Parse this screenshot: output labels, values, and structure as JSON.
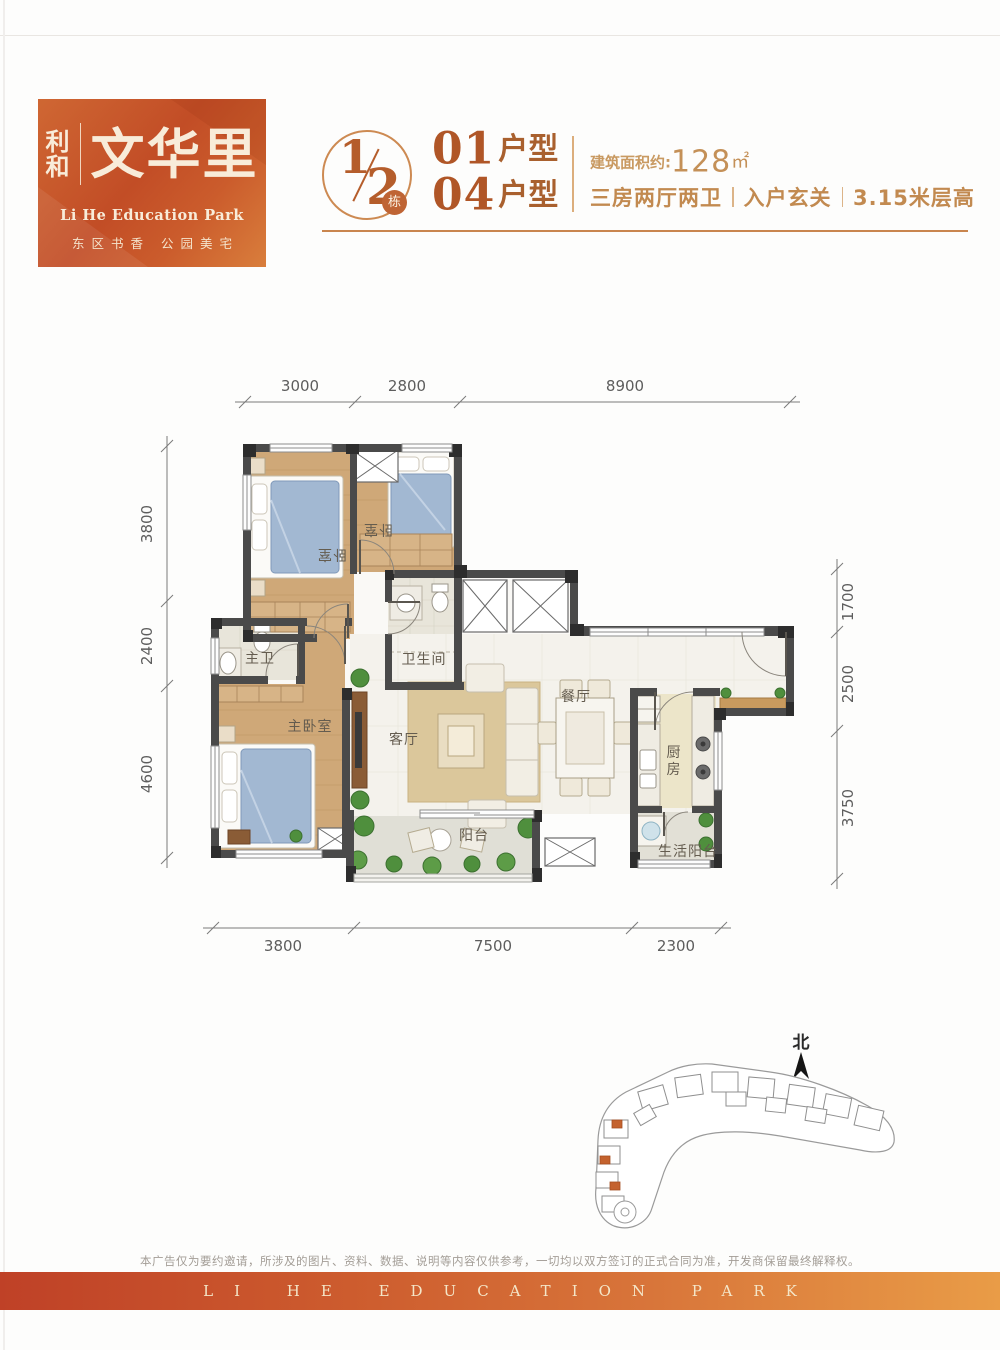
{
  "colors": {
    "brand_orange": "#c2582a",
    "accent_text": "#b05627",
    "banner_gradient_left": "#bf4127",
    "banner_gradient_right": "#e99c47",
    "wall": "#4a4a4a",
    "highlight_unit": "#c4622e"
  },
  "logo": {
    "brand": "利和",
    "name": "文华里",
    "subtitle_en": "Li He Education Park",
    "tagline": "东区书香 公园美宅"
  },
  "header": {
    "block": {
      "numerator": "1",
      "denominator": "2",
      "badge": "栋"
    },
    "units": [
      {
        "num": "01",
        "type": "户型"
      },
      {
        "num": "04",
        "type": "户型"
      }
    ],
    "area": {
      "label": "建筑面积约:",
      "value": "128",
      "unit": "㎡"
    },
    "features": [
      "三房两厅两卫",
      "入户玄关",
      "3.15米层高"
    ]
  },
  "floorplan": {
    "rooms": [
      {
        "id": "bedroom-1",
        "label": "卧室"
      },
      {
        "id": "bedroom-2",
        "label": "卧室"
      },
      {
        "id": "bathroom",
        "label": "卫生间"
      },
      {
        "id": "master-bath",
        "label": "主卫"
      },
      {
        "id": "master-bedroom",
        "label": "主卧室"
      },
      {
        "id": "living-room",
        "label": "客厅"
      },
      {
        "id": "dining-room",
        "label": "餐厅"
      },
      {
        "id": "kitchen",
        "label": "厨房"
      },
      {
        "id": "balcony",
        "label": "阳台"
      },
      {
        "id": "service-balcony",
        "label": "生活阳台"
      }
    ],
    "dimensions": {
      "top": [
        "3000",
        "2800",
        "8900"
      ],
      "bottom": [
        "3800",
        "7500",
        "2300"
      ],
      "left": [
        "3800",
        "2400",
        "4600"
      ],
      "right": [
        "1700",
        "2500",
        "3750"
      ]
    }
  },
  "siteplan": {
    "north": "北"
  },
  "footer": {
    "disclaimer": "本广告仅为要约邀请，所涉及的图片、资料、数据、说明等内容仅供参考，一切均以双方签订的正式合同为准，开发商保留最终解释权。",
    "banner": "LI HE EDUCATION PARK"
  }
}
